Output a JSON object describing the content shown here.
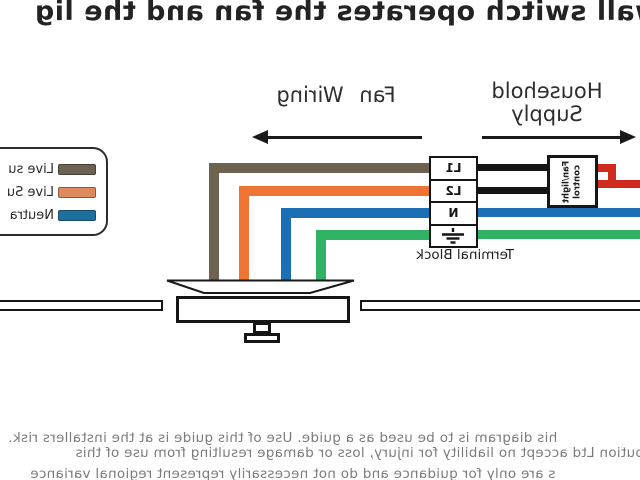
{
  "title": "wall switch operates the fan and the lig",
  "header": {
    "household_supply": {
      "line1": "Household",
      "line2": "Supply"
    },
    "fan_wiring": "Fan Wiring"
  },
  "legend": {
    "items": [
      {
        "label": "Live su",
        "color": "#6e6250"
      },
      {
        "label": "Live Su",
        "color": "#de8a5c"
      },
      {
        "label": "Neutra",
        "color": "#1f6f9e"
      }
    ]
  },
  "terminal_block": {
    "label": "Terminal Block",
    "terminals": [
      {
        "label": "L1"
      },
      {
        "label": "L2"
      },
      {
        "label": "N"
      },
      {
        "label": "earth"
      }
    ]
  },
  "control_box": {
    "line1": "Fan/light",
    "line2": "control"
  },
  "wire_colors": {
    "live_brown": "#6e6250",
    "switched_orange": "#ef7434",
    "neutral_blue": "#1c6fb4",
    "earth_green": "#2fb264",
    "supply_red": "#d02b1f",
    "link_black": "#141414"
  },
  "footer": {
    "line1": "his diagram is to be used as a guide.  Use of this guide is at the installers risk.",
    "line2": "ibution Ltd accept no liability for injury, loss or damage resulting from use of this",
    "line3": "s are only for guidance and do not necessarily represent regional variance"
  }
}
